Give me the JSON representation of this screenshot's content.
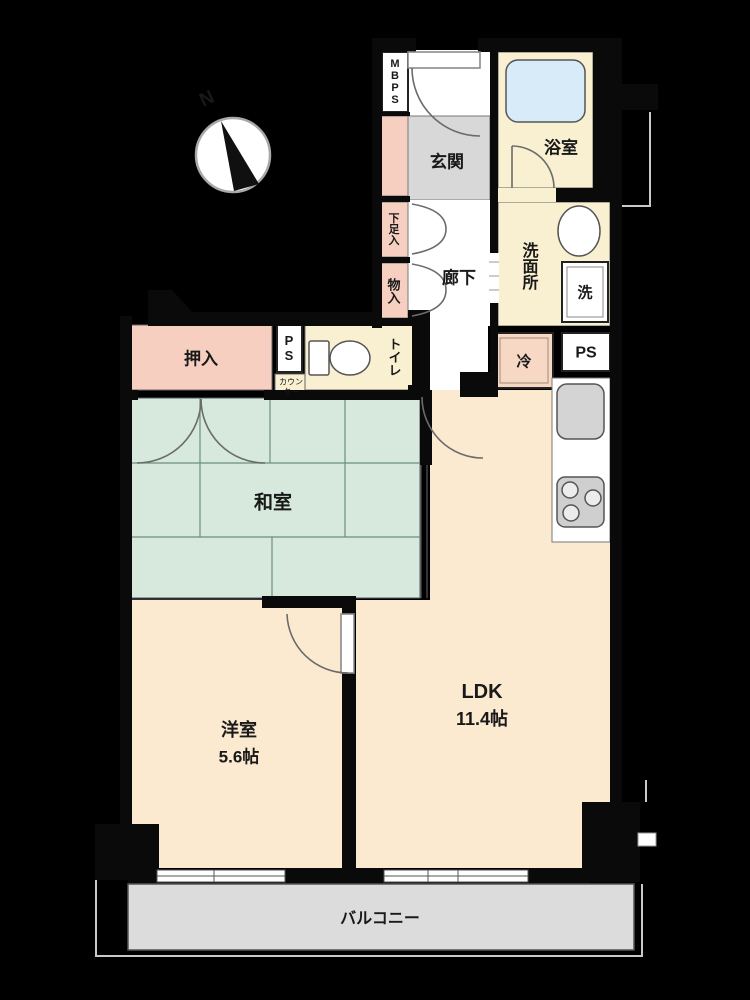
{
  "plan": {
    "compass": {
      "north_label": "N"
    },
    "rooms": {
      "mbps": "MBPS",
      "genkan": "玄関",
      "bathroom": "浴室",
      "washroom": "洗面所",
      "laundry": "洗",
      "hallway": "廊下",
      "shoe_box": "下足入",
      "storage": "物入",
      "toilet": "トイレ",
      "ps_upper": "PS",
      "counter_line1": "カウン",
      "counter_line2": "ター",
      "oshiire": "押入",
      "fridge": "冷",
      "ps_kitchen": "PS",
      "washitsu": "和室",
      "yoshitsu": "洋室",
      "yoshitsu_size": "5.6帖",
      "ldk": "LDK",
      "ldk_size": "11.4帖",
      "balcony": "バルコニー"
    },
    "colors": {
      "wall": "#000000",
      "room_cream": "#fbe9d0",
      "tatami_green": "#d6e9dc",
      "closet_pink": "#f6cfc0",
      "entry_gray": "#d8d8d8",
      "balcony_gray": "#dcdcdc",
      "bathtub_blue": "#d7ecf8"
    }
  }
}
